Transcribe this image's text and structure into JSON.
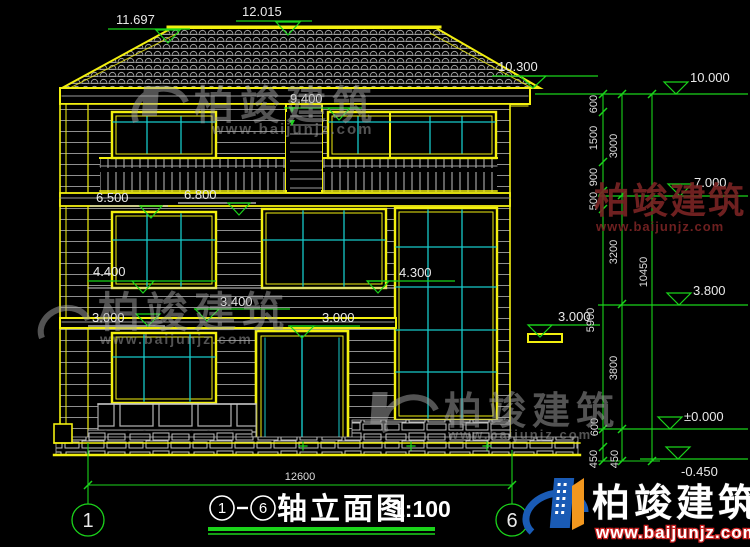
{
  "drawing": {
    "title": {
      "axis_start": "1",
      "axis_end": "6",
      "name": "轴立面图",
      "scale": "1:100"
    },
    "axis_bubbles": {
      "left": "1",
      "right": "6"
    },
    "levels": {
      "roof_left": "11.697",
      "ridge": "12.015",
      "eave": "10.300",
      "win3_top": "9.400",
      "win2_left_top": "6.500",
      "win2_mid_top": "6.800",
      "win2_sill": "4.400",
      "stair_mid": "4.300",
      "canopy_top": "3.400",
      "floor1_left": "3.000",
      "floor1_mid": "3.000",
      "floor1_right": "3.000",
      "right_top": "10.000",
      "right_7000": "7.000",
      "right_3800": "3.800",
      "right_zero": "±0.000",
      "right_neg": "-0.450"
    },
    "dim_chain_inner": [
      "600",
      "1500",
      "900",
      "500",
      "5900",
      "600",
      "450"
    ],
    "dim_chain_middle": [
      "3000",
      "3200",
      "3800",
      "450"
    ],
    "dim_total_right": "10450",
    "dim_width": "12600"
  },
  "watermark": {
    "name": "柏竣建筑",
    "url": "www.baijunjz.com"
  },
  "colors": {
    "line_yellow": "#f2ef0f",
    "line_green": "#1bd31b",
    "line_cyan": "#17c9c9",
    "text_white": "#e9e9e9"
  }
}
